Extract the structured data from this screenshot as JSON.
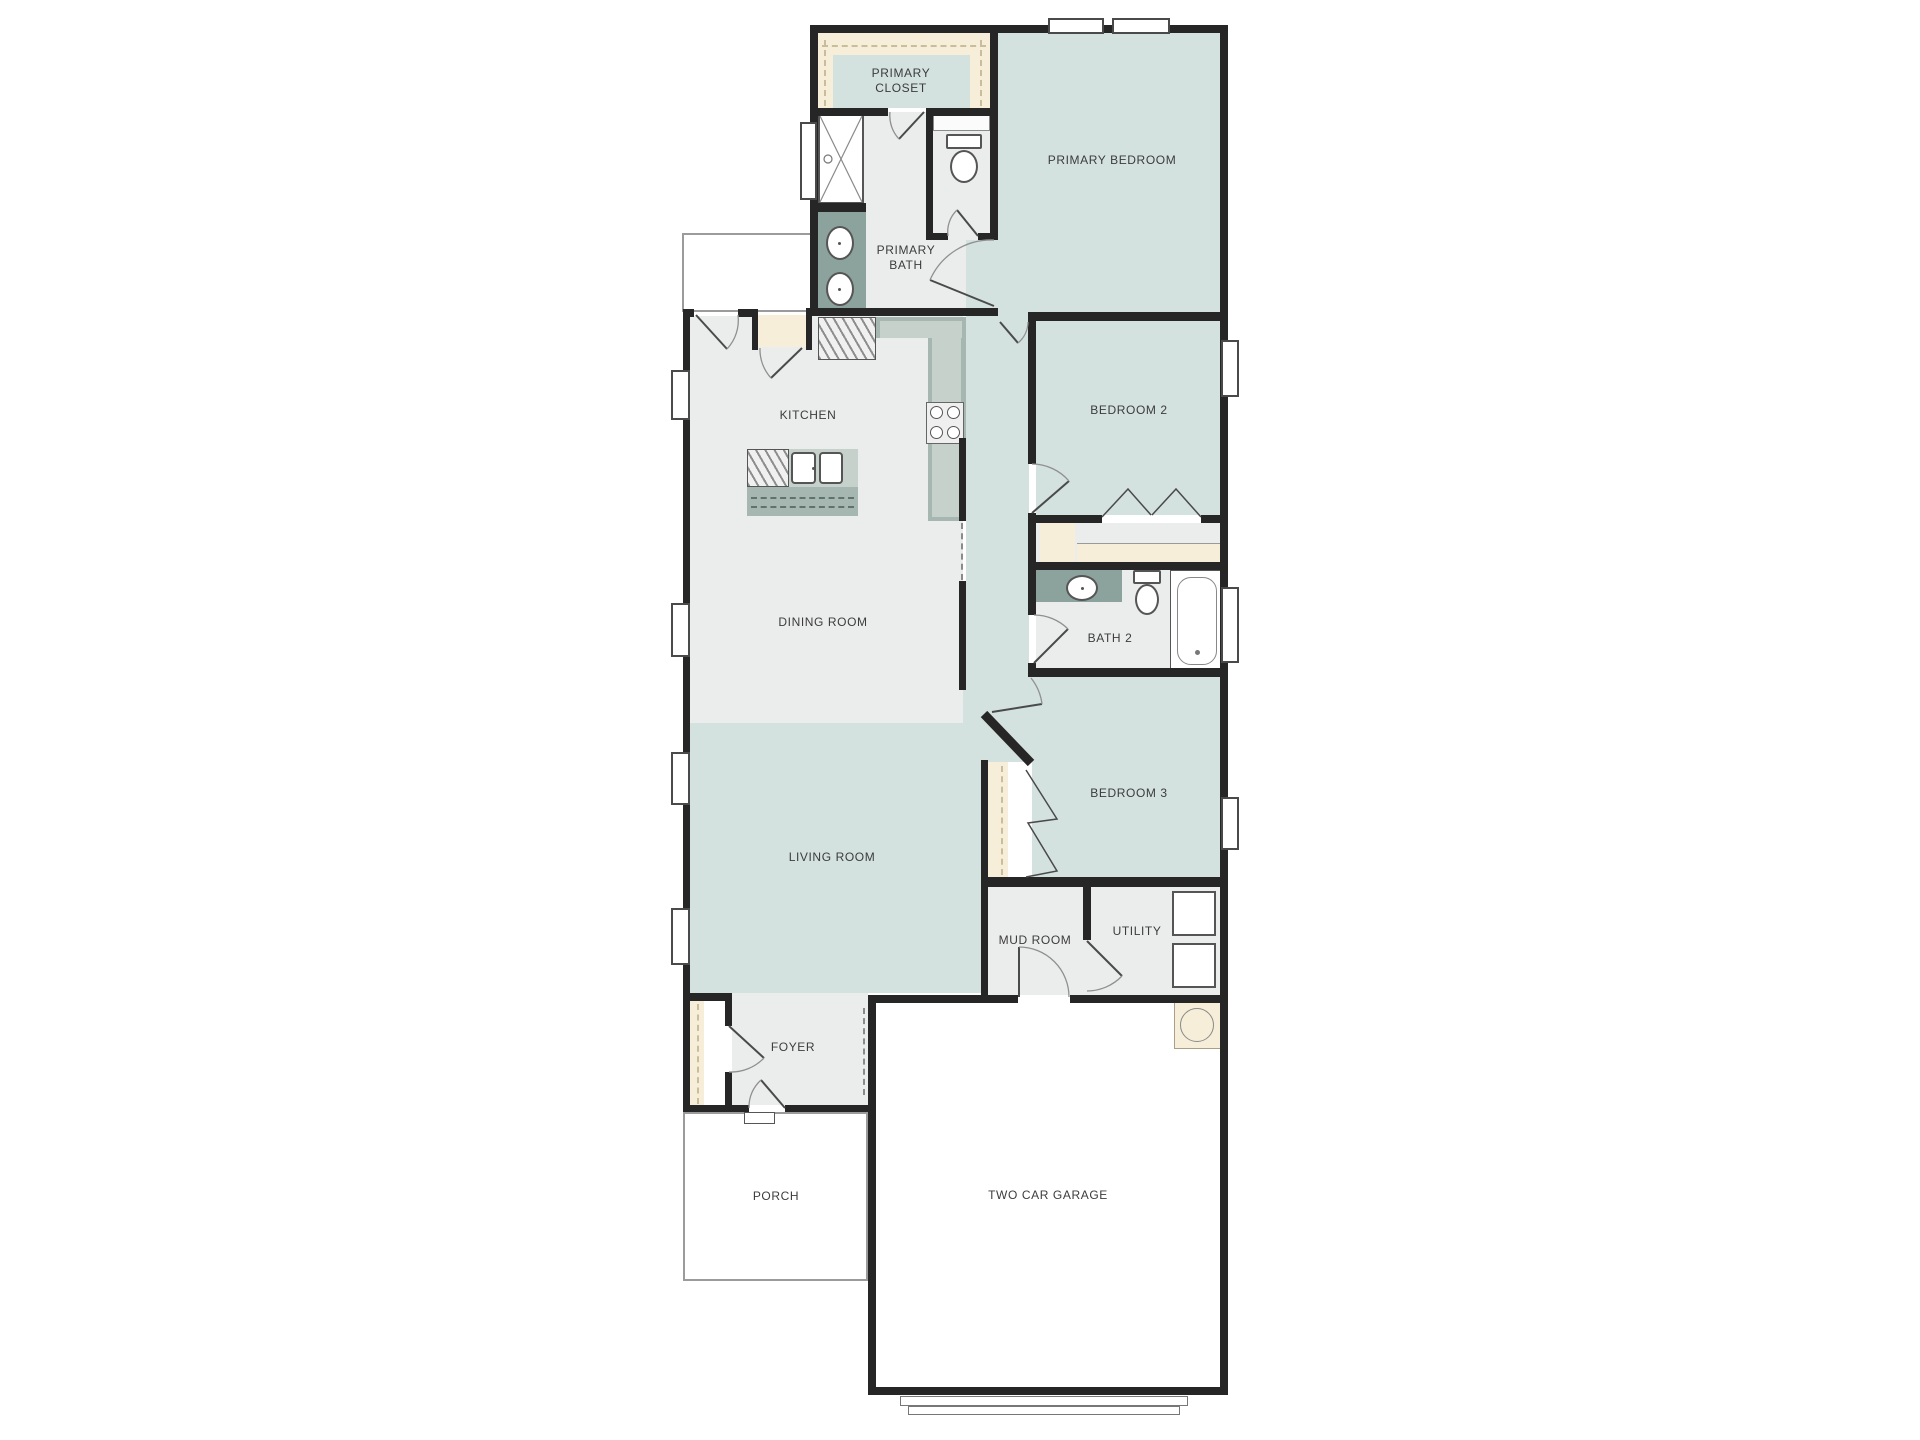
{
  "rooms": {
    "primary_closet": "PRIMARY CLOSET",
    "primary_bath": "PRIMARY BATH",
    "primary_bedroom": "PRIMARY BEDROOM",
    "kitchen": "KITCHEN",
    "bedroom_2": "BEDROOM 2",
    "dining_room": "DINING ROOM",
    "bath_2": "BATH 2",
    "bedroom_3": "BEDROOM 3",
    "living_room": "LIVING ROOM",
    "mud_room": "MUD ROOM",
    "utility": "UTILITY",
    "foyer": "FOYER",
    "porch": "PORCH",
    "garage": "TWO CAR GARAGE"
  },
  "colors": {
    "room_teal": "#d3e1df",
    "floor_light": "#ebedec",
    "closet_cream": "#f6eed9",
    "wall": "#262626",
    "counter": "#a6b7b2",
    "counter_light": "#c6d1cc",
    "vanity": "#8ba29d"
  }
}
